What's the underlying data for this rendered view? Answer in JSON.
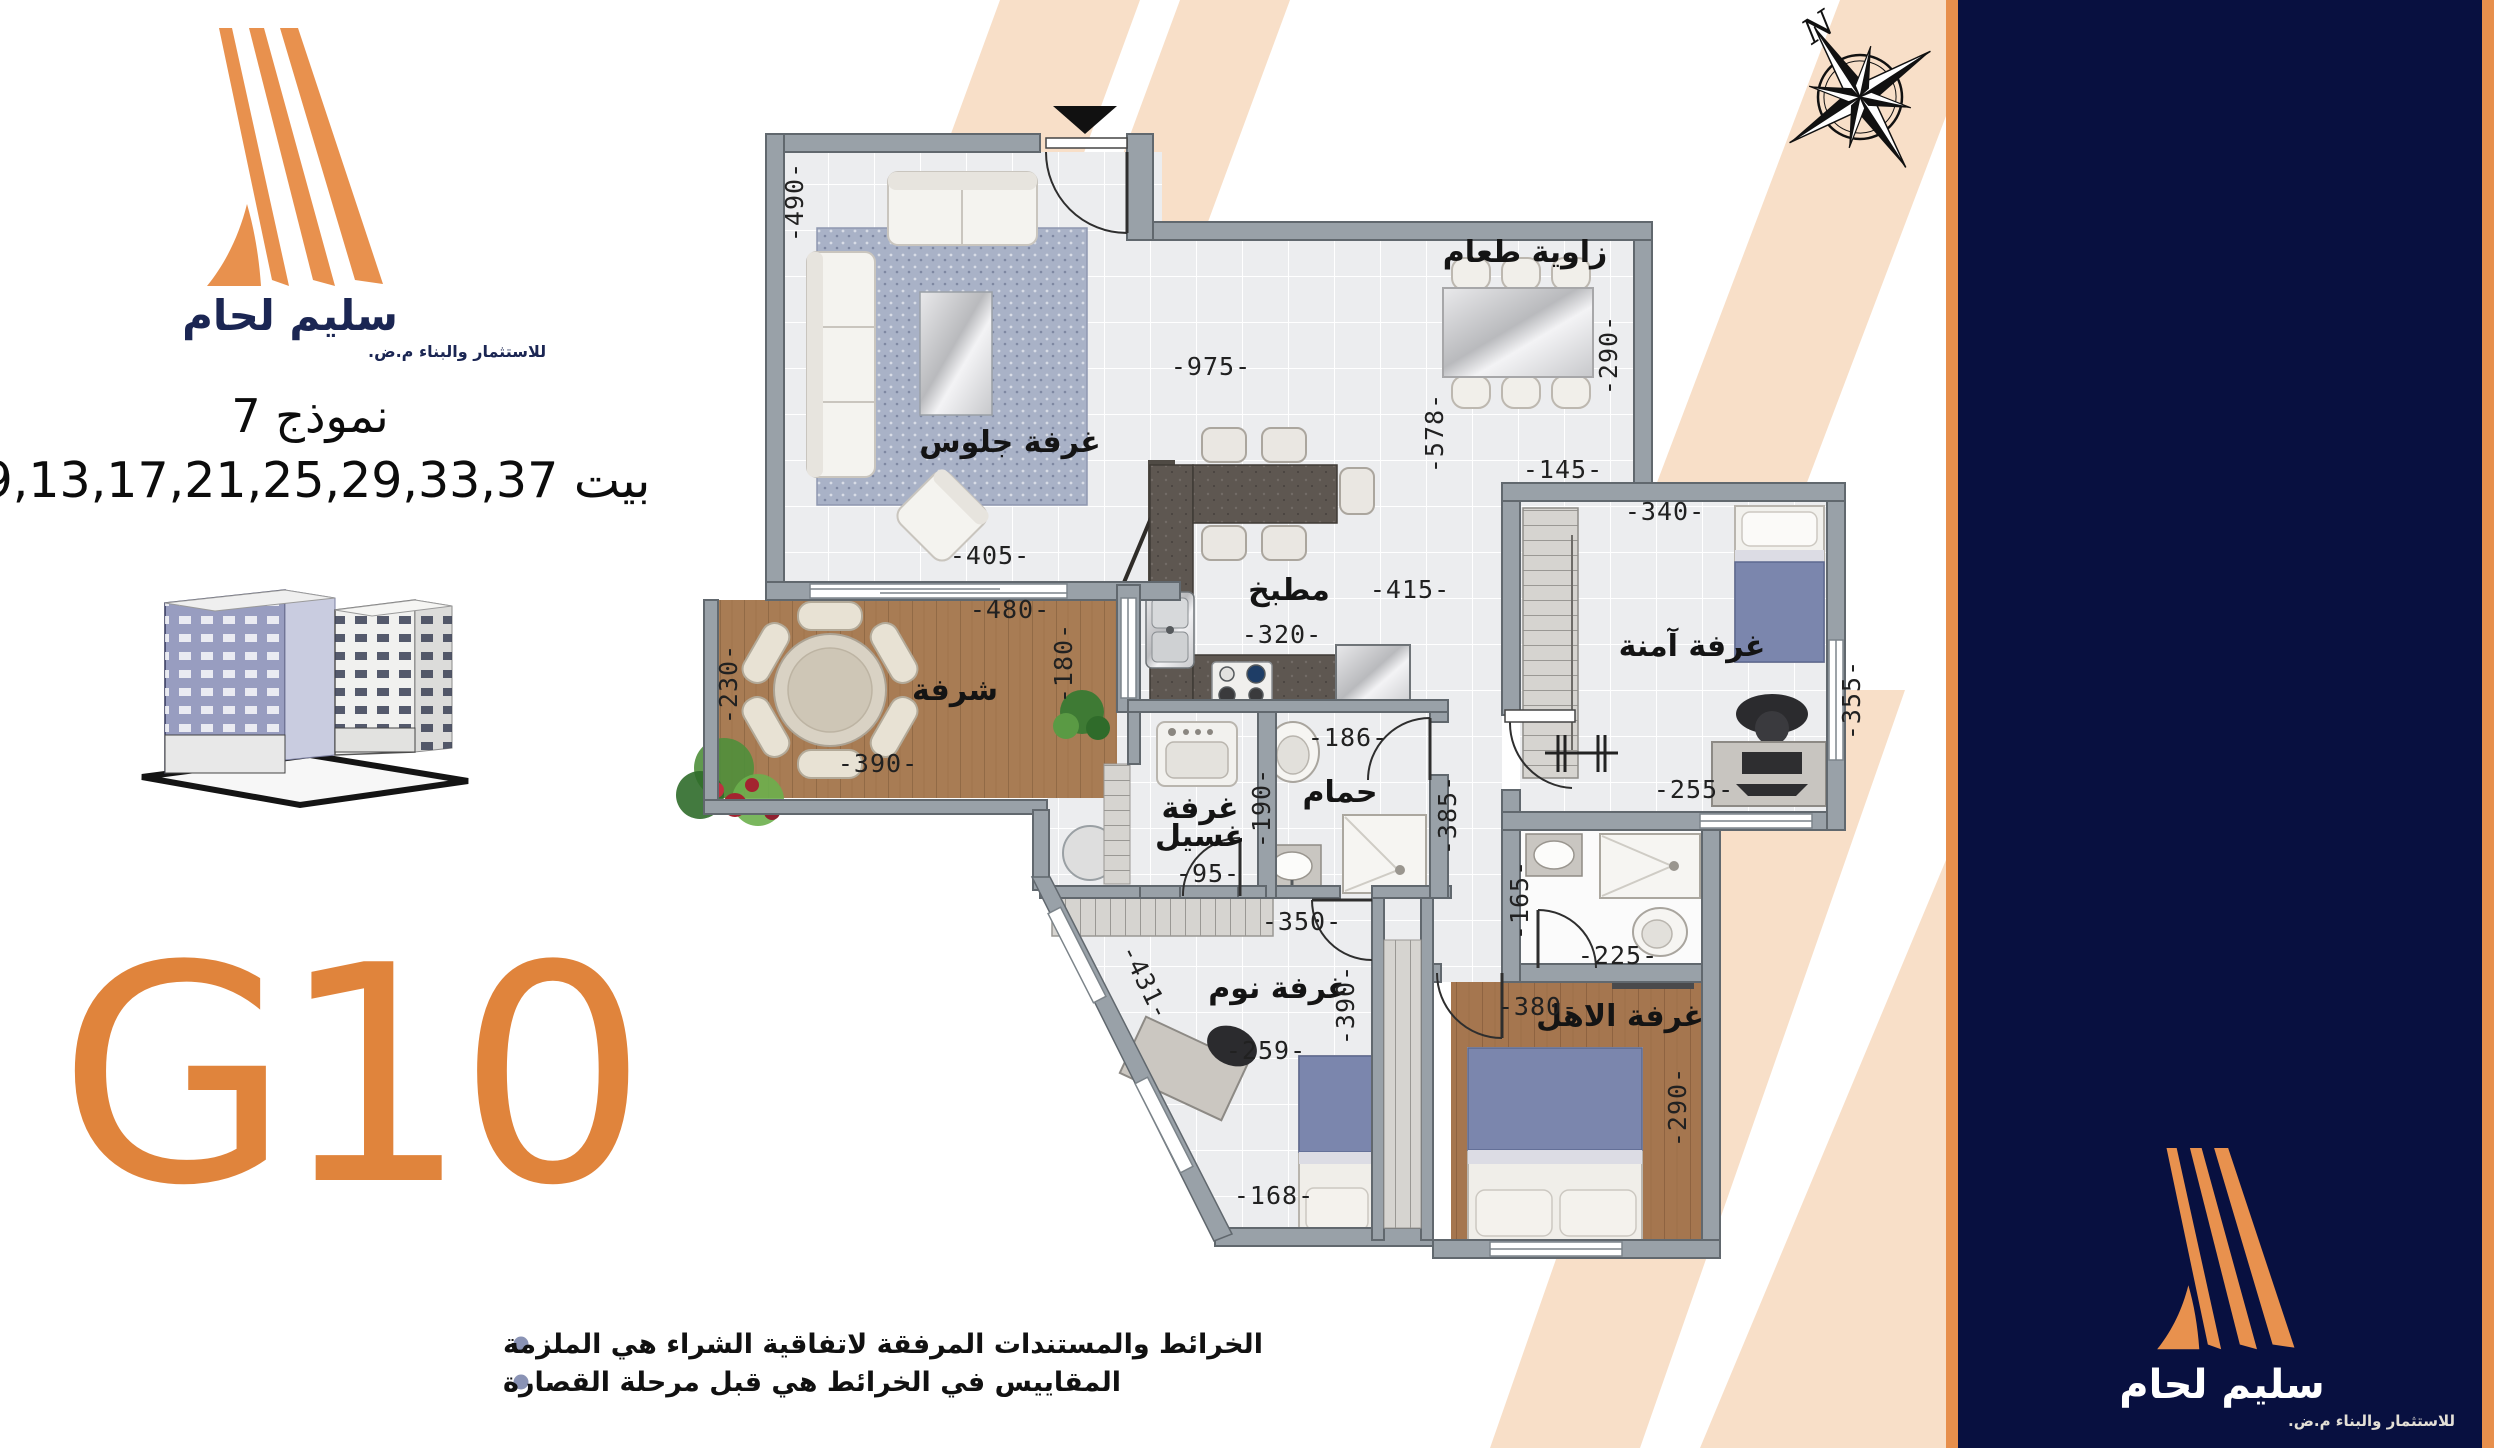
{
  "brand": {
    "name": "سليم لحام",
    "tagline": "للاستثمار والبناء م.ض."
  },
  "header": {
    "model": "نموذج 7",
    "houses": "بيت 9,13,17,21,25,29,33,37"
  },
  "unit_code": "G10",
  "compass": {
    "north": "N"
  },
  "notes": [
    "الخرائط والمستندات المرفقة لاتفاقية الشراء هي الملزمة",
    "المقاييس في الخرائط هي قبل مرحلة القصارة"
  ],
  "colors": {
    "accent_orange": "#E0843C",
    "logo_orange": "#E8914E",
    "navy": "#081040",
    "peach": "#F8DFC8",
    "wall_gray": "#99A1A8",
    "wood": "#A87C54",
    "blanket_blue": "#7B86AD"
  },
  "plan": {
    "rooms": {
      "living": "غرفة جلوس",
      "dining": "زاوية طعام",
      "kitchen": "مطبخ",
      "balcony": "شرفة",
      "laundry_l1": "غرفة",
      "laundry_l2": "غسيل",
      "bath": "حمام",
      "safe": "غرفة آمنة",
      "bedroom": "غرفة نوم",
      "master": "غرفة الاهل"
    },
    "dims": {
      "living_h": "-490-",
      "living_w": "-405-",
      "dining_w": "-975-",
      "dining_h": "-290-",
      "open_h": "-578-",
      "safe_gap": "-145-",
      "safe_w": "-340-",
      "safe_h": "-355-",
      "safe_desk": "-255-",
      "kitchen_w": "-415-",
      "kitchen_c": "-320-",
      "bath_t": "-186-",
      "laundry_h": "-190-",
      "laundry_w": "-95-",
      "hall_h": "-385-",
      "hall_w": "-350-",
      "mbath_h": "-165-",
      "mbath_w": "-225-",
      "master_w": "-380-",
      "master_h": "-290-",
      "bed_diag": "-431-",
      "bed_w1": "-259-",
      "bed_w2": "-168-",
      "bed_h": "-390-",
      "balc_w": "-480-",
      "balc_l": "-230-",
      "balc_b": "-390-",
      "balc_r": "-180-"
    }
  }
}
